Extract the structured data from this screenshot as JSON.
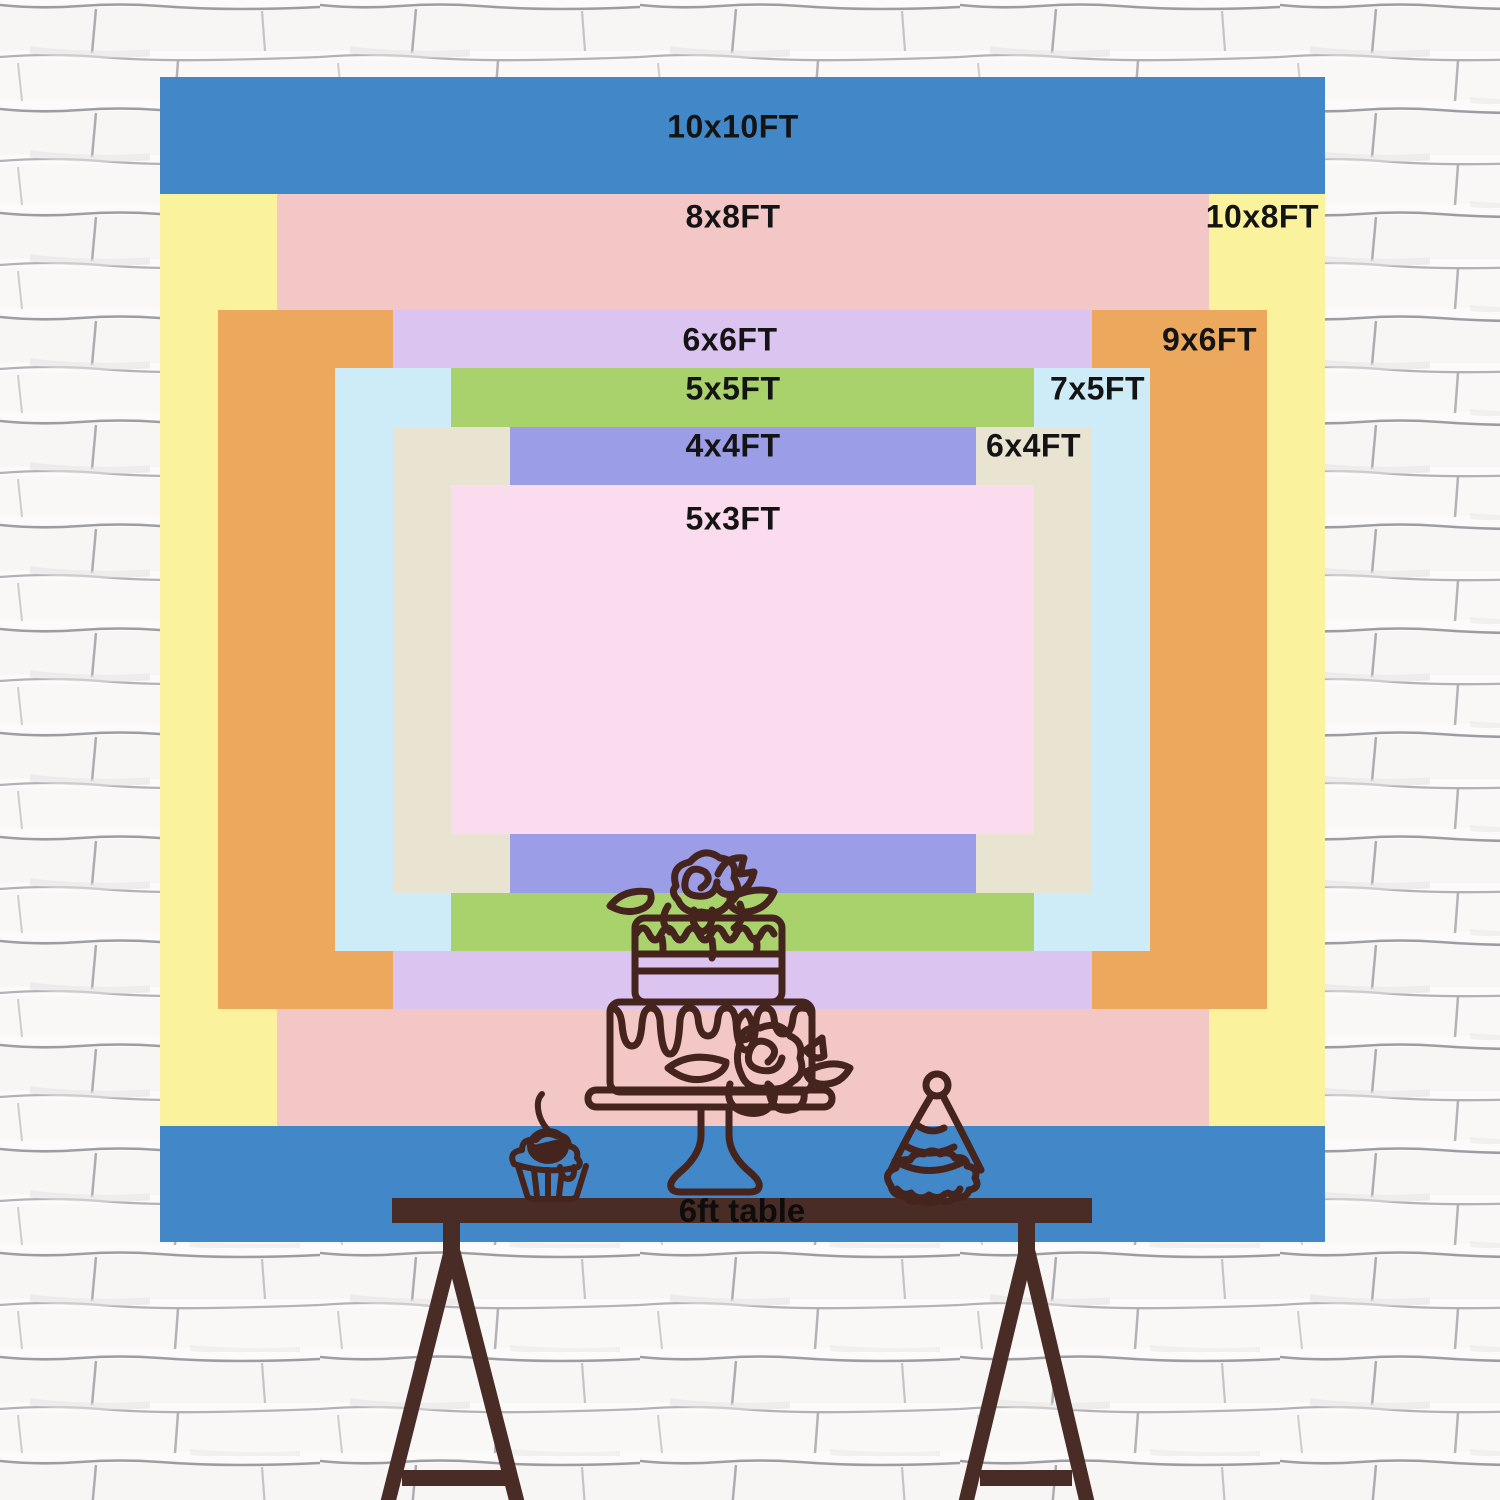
{
  "title": "Backdrop size comparison chart",
  "chart_data": {
    "type": "nested-area-comparison",
    "unit": "FT",
    "px_per_ft": 116.5,
    "center_x": 742.5,
    "center_y": 659.5,
    "label_color": "#141414",
    "sizes": [
      {
        "label": "10x10FT",
        "w_ft": 10,
        "h_ft": 10,
        "color": "#4287c7",
        "label_x": 733,
        "label_y": 127,
        "align": "center"
      },
      {
        "label": "10x8FT",
        "w_ft": 10,
        "h_ft": 8,
        "color": "#fbf29e",
        "label_x": 1319,
        "label_y": 217,
        "align": "right"
      },
      {
        "label": "8x8FT",
        "w_ft": 8,
        "h_ft": 8,
        "color": "#f2c7c6",
        "label_x": 733,
        "label_y": 217,
        "align": "center"
      },
      {
        "label": "9x6FT",
        "w_ft": 9,
        "h_ft": 6,
        "color": "#eca95d",
        "label_x": 1257,
        "label_y": 340,
        "align": "right"
      },
      {
        "label": "6x6FT",
        "w_ft": 6,
        "h_ft": 6,
        "color": "#dbc5f0",
        "label_x": 730,
        "label_y": 340,
        "align": "center"
      },
      {
        "label": "7x5FT",
        "w_ft": 7,
        "h_ft": 5,
        "color": "#cdecf7",
        "label_x": 1145,
        "label_y": 389,
        "align": "right"
      },
      {
        "label": "5x5FT",
        "w_ft": 5,
        "h_ft": 5,
        "color": "#a9d26c",
        "label_x": 733,
        "label_y": 389,
        "align": "center"
      },
      {
        "label": "6x4FT",
        "w_ft": 6,
        "h_ft": 4,
        "color": "#e9e4d2",
        "label_x": 1081,
        "label_y": 446,
        "align": "right"
      },
      {
        "label": "4x4FT",
        "w_ft": 4,
        "h_ft": 4,
        "color": "#9c9de7",
        "label_x": 733,
        "label_y": 446,
        "align": "center"
      },
      {
        "label": "5x3FT",
        "w_ft": 5,
        "h_ft": 3,
        "color": "#fbdcee",
        "label_x": 733,
        "label_y": 519,
        "align": "center"
      }
    ]
  },
  "table": {
    "label": "6ft table",
    "label_x": 742,
    "label_y": 1211,
    "color": "#4a2c26"
  },
  "illustrations": {
    "stroke_color": "#45241e",
    "items": [
      "cake-icon",
      "cupcake-icon",
      "party-hat-icon",
      "trestle-table"
    ]
  },
  "wall": {
    "brick_bg": "#fcfbfa",
    "mortar_dark": "#87868c",
    "mortar_light": "#a2a1a8"
  }
}
